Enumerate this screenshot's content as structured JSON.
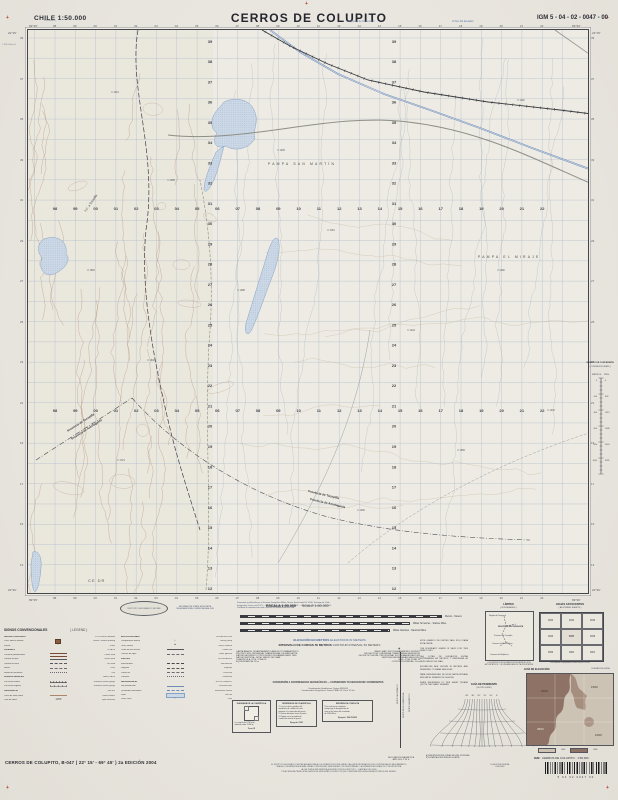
{
  "header": {
    "country_scale": "CHILE  1:50.000",
    "title": "CERROS DE COLUPITO",
    "sheet_code": "IGM 5 - 04 - 02 - 0047 - 00",
    "note_left": "Al Oeste de Greenwich",
    "note_right": "Al Sur del Ecuador"
  },
  "map": {
    "corner": {
      "tl_lon": "69°45'",
      "tr_lon": "69°30'",
      "tl_lat": "22°15'",
      "bl_lat": "22°30'",
      "ref_e": "398.000m E",
      "ref_n": "7.539.000m N"
    },
    "eastings": [
      "98",
      "99",
      "00",
      "01",
      "02",
      "03",
      "04",
      "05",
      "06",
      "07",
      "08",
      "09",
      "10",
      "11",
      "12",
      "13",
      "14",
      "15",
      "16",
      "17",
      "18",
      "19",
      "20",
      "21",
      "22"
    ],
    "northings": [
      "39",
      "38",
      "37",
      "36",
      "35",
      "34",
      "33",
      "32",
      "31",
      "30",
      "29",
      "28",
      "27",
      "26",
      "25",
      "24",
      "23",
      "22",
      "21",
      "20",
      "19",
      "18",
      "17",
      "16",
      "15",
      "14",
      "13",
      "12"
    ],
    "places": {
      "pampa1": "PAMPA SAN MARTÍN",
      "pampa2": "PAMPA EL MIRAJE",
      "prov_a": "Provincia de Tocopilla",
      "prov_b": "Provincia de Antofagasta",
      "rail_label": "F.C. a Tocopilla",
      "station": "CE DR"
    },
    "spots": [
      {
        "x": 84,
        "y": 62,
        "v": "1310"
      },
      {
        "x": 140,
        "y": 150,
        "v": "1485"
      },
      {
        "x": 60,
        "y": 240,
        "v": "1562"
      },
      {
        "x": 120,
        "y": 330,
        "v": "1640"
      },
      {
        "x": 90,
        "y": 430,
        "v": "1721"
      },
      {
        "x": 210,
        "y": 260,
        "v": "1288"
      },
      {
        "x": 300,
        "y": 200,
        "v": "1154"
      },
      {
        "x": 380,
        "y": 300,
        "v": "1243"
      },
      {
        "x": 470,
        "y": 240,
        "v": "1199"
      },
      {
        "x": 430,
        "y": 420,
        "v": "1356"
      },
      {
        "x": 520,
        "y": 380,
        "v": "1402"
      },
      {
        "x": 330,
        "y": 480,
        "v": "1450"
      },
      {
        "x": 250,
        "y": 120,
        "v": "1235"
      },
      {
        "x": 490,
        "y": 70,
        "v": "1120"
      }
    ]
  },
  "legend": {
    "title": "SIGNOS CONVENCIONALES",
    "title_en": "( LEGEND )",
    "col1": [
      {
        "h": "ÁREAS POBLADAS",
        "he": "POPULATED AREAS"
      },
      {
        "es": "Casa, edificio aislado",
        "en": "House, isolated building",
        "sym": "building"
      },
      {
        "es": "Ruinas",
        "en": "Ruins",
        "sym": "glyph",
        "g": "∷"
      },
      {
        "h": "CAMINOS",
        "he": "ROADS"
      },
      {
        "es": "Carretera pavimentada",
        "en": "Paved road",
        "sym": "road2"
      },
      {
        "es": "Camino de ripio",
        "en": "Gravel road",
        "sym": "road1"
      },
      {
        "es": "Camino de tierra",
        "en": "Dirt road",
        "sym": "roadd"
      },
      {
        "es": "Huella",
        "en": "Track",
        "sym": "dash"
      },
      {
        "es": "Senda de herradura",
        "en": "Trail",
        "sym": "dots"
      },
      {
        "h": "FERROCARRILES",
        "he": "RAILROADS"
      },
      {
        "es": "Vía férrea normal",
        "en": "Railroad, normal gauge",
        "sym": "rail"
      },
      {
        "es": "Vía férrea angosta",
        "en": "Railroad, narrow gauge",
        "sym": "rail2"
      },
      {
        "h": "OROGRAFÍA",
        "he": "RELIEF"
      },
      {
        "es": "Curva de nivel índice",
        "en": "Index contour",
        "sym": "contour"
      },
      {
        "es": "Cota de altura",
        "en": "Spot elevation",
        "sym": "glyph",
        "g": "·1250"
      }
    ],
    "col2": [
      {
        "h": "INSTALACIONES",
        "he": "INSTALLATIONS"
      },
      {
        "es": "Campamento minero",
        "en": "Mining camp",
        "sym": "glyph",
        "g": "▪"
      },
      {
        "es": "Torre, antena",
        "en": "Tower, antenna",
        "sym": "glyph",
        "g": "▲"
      },
      {
        "es": "Línea de alta tensión",
        "en": "Power line",
        "sym": "power"
      },
      {
        "es": "Cañería de agua",
        "en": "Water pipeline",
        "sym": "b3"
      },
      {
        "h": "LÍMITES",
        "he": "BOUNDARIES"
      },
      {
        "es": "Internacional",
        "en": "International",
        "sym": "b1"
      },
      {
        "es": "Regional",
        "en": "Regional",
        "sym": "b2"
      },
      {
        "es": "Provincial",
        "en": "Provincial",
        "sym": "b3"
      },
      {
        "es": "Comunal",
        "en": "Communal",
        "sym": "b4"
      },
      {
        "h": "HIDROGRAFÍA",
        "he": "HYDROGRAPHY"
      },
      {
        "es": "Río permanente",
        "en": "Perennial river",
        "sym": "river"
      },
      {
        "es": "Quebrada intermitente",
        "en": "Intermittent stream",
        "sym": "istream"
      },
      {
        "es": "Salar",
        "en": "Salt flat",
        "sym": "salar"
      },
      {
        "es": "Pozo, noria",
        "en": "Well",
        "sym": "glyph",
        "g": "○"
      }
    ]
  },
  "footer": {
    "logo_text": "INSTITUTO GEOGRÁFICO MILITAR",
    "pub_lines": [
      "Preparado y publicado por el Instituto Geográfico Militar, Nueva Santa Isabel N° 1640, Santiago de Chile.",
      "Fotografías aéreas año 1997 — Restitución fotogramétrica año 2000 — Comprobación terrestre año 2002.",
      "Prohibida la reproducción total o parcial sin autorización del IGM."
    ],
    "info_lines": [
      "INFORMACIÓN SOBRE ESTA CARTA",
      "SE AGRADECERÁ COMUNICARLA AL IGM"
    ],
    "escala": "ESCALA 1:50.000",
    "escala_en": "SCALE 1:50.000",
    "bar_labels": [
      "Metros · Meters",
      "Millas Terrestres · Statute Miles",
      "Millas Náuticas · Nautical Miles"
    ],
    "elev": "ELEVACIÓN EN METROS",
    "elev_en": "ELEVATIONS IN METERS",
    "interval": "INTERVALO DE CURVAS 50 METROS",
    "interval_en": "CONTOUR INTERVAL 50 METERS",
    "datum_es": [
      "CARTA BÁSICA: LEVANTAMIENTO AEROFOTOGRAMÉTRICO",
      "PROYECCIÓN: UNIVERSAL TRANSVERSAL DE MERCATOR",
      "DATUM GEODÉSICO: PROVISORIO SUDAMERICANO 1956",
      "DATUM VERTICAL: NIVEL MEDIO DEL MAR",
      "CUADRÍCULA: UTM, ZONA 19",
      "EQUIDISTANCIA: 50 m"
    ],
    "datum_en": [
      "BASIC MAP: PHOTOGRAMMETRIC SURVEY",
      "PROJECTION: UNIVERSAL TRANSVERSE MERCATOR",
      "GEODETIC DATUM: PROVISIONAL SOUTH AMERICAN 1956",
      "VERTICAL DATUM: MEAN SEA LEVEL",
      "GRID: UTM, ZONE 19",
      "CONTOUR INTERVAL: 50 m"
    ],
    "conv_title": "CONVERSIÓN A COORDENADAS GEOGRÁFICAS — CONVERSION TO GEOGRAPHIC COORDINATES",
    "conv_lines": [
      "Coordenadas Geodésicas: Datum WGS-84",
      "Coordenadas Geográficas: Datum PSAD-56, Zona 19 Sur"
    ],
    "box1": {
      "title": "DIAGRAMA DE LA CUADRÍCULA",
      "lines": [
        "La cuadrícula UTM está",
        "indicada cada 1.000 m"
      ],
      "example": "Zona 19"
    },
    "box2": {
      "title": "REFERENCIA DE CUADRÍCULA",
      "lines": [
        "1. Lea las cifras grandes del",
        "meridiano de cuadrícula más",
        "próximo a la izquierda del punto.",
        "2. Estime décimos hacia el punto.",
        "3. Repita con el paralelo de",
        "cuadrícula inferior al punto."
      ],
      "example": "Ejemplo: 0536"
    },
    "box3": {
      "title": "REFERENCIA COMPLETA",
      "lines": [
        "Para referencia completa",
        "anteponga la designación de",
        "zona y las letras del cuadrado",
        "de 100.000 m."
      ],
      "example": "Ejemplo: 19K 053653"
    },
    "magnetic": {
      "n1": "NORTE GEOGRÁFICO",
      "n2": "NORTE DE LA CUADRÍCULA",
      "n3": "NORTE MAGNÉTICO",
      "note": [
        "DECLINACIÓN MAGNÉTICA",
        "AÑO 2004: 2°30' E"
      ]
    },
    "notes_col": [
      "ESTE GRÁFICO DE LÍMITES VALE SÓLO PARA ESTA CARTA.",
      "THE BOUNDARY GRAPH IS VALID FOR THIS SHEET ONLY.",
      "LAS COTAS DE ELEVACIÓN ESTÁN EXPRESADAS EN METROS Y REFERIDAS AL NIVEL MEDIO DEL MAR.",
      "ELEVATIONS ARE SHOWN IN METERS AND REFERRED TO MEAN SEA LEVEL.",
      "PARA REFERENCIAS DE ESTA CARTA SÍRVASE INDICAR EL NÚMERO DE LA HOJA.",
      "WHEN REFERRING TO THIS SHEET PLEASE QUOTE THE SHEET NUMBER."
    ],
    "limites": {
      "title": "LÍMITES",
      "title_en": "( BOUNDARIES )",
      "labels": [
        "Región de Tarapacá",
        "REGIÓN DE ANTOFAGASTA",
        "Provincia de Tocopilla",
        "Comuna de María Elena",
        "Comuna de Mejillones"
      ],
      "note": "LOS LÍMITES QUE FIGURAN EN ESTA CARTA NO SON AUTORITATIVOS — BOUNDARIES ARE NOT AUTHORITATIVE"
    },
    "adjoining": {
      "title": "HOJAS ADYACENTES",
      "title_en": "( ADJOINING SHEETS )",
      "cells": [
        "0033",
        "0034",
        "0035",
        "0046",
        "0047",
        "0048",
        "0059",
        "0060",
        "0061"
      ],
      "note": "Los números corresponden a cartas escala 1:50.000"
    },
    "slope": {
      "title": "GUÍA DE PENDIENTE",
      "title_en": "( SLOPE GUIDE )",
      "top_labels": [
        "45°",
        "30°",
        "20°",
        "15°",
        "10°",
        "5°"
      ],
      "foot": [
        "A) PENDIENTE ENTRE CURVAS DE NIVEL SUCESIVAS",
        "B) DISTANCIA HORIZONTAL EN LA CARTA"
      ]
    },
    "elevguide": {
      "title": "GUÍA DE ELEVACIÓN",
      "title_en": "ELEVATION GUIDE",
      "labels": [
        "2000",
        "1500",
        "1000",
        "2500"
      ],
      "legend": [
        "1040",
        "3065"
      ]
    },
    "conversion": {
      "title": "GRÁFICO DE CONVERSIÓN",
      "subtitle": "( CONVERSION GRAPH )",
      "left": "METROS",
      "right": "PIES",
      "m": [
        "0",
        "200",
        "400",
        "600",
        "800",
        "1000"
      ],
      "p": [
        "0",
        "656",
        "1312",
        "1968",
        "2624",
        "3281"
      ]
    },
    "bottom": {
      "title_line": "CERROS DE COLUPITO, B-047 ( 22° 15' - 69° 45' ) 2a EDICIÓN 2004",
      "center_lines": [
        "EL INSTITUTO GEOGRÁFICO MILITAR AGRADECERÁ A LOS USUARIOS DE ESTA CARTA CUALQUIER INFORMACIÓN QUE CONTRIBUYA A SU MEJORAMIENTO,",
        "SEA EN LO REFERENTE A NUEVAS OBRAS CONSTRUIDAS, VÍAS NUEVAS O NO REGISTRADAS, O A NOMBRES GEOGRÁFICOS Y SU ESCRITURA,",
        "LA QUE PUEDE SER REMITIDA A LA DIRECCIÓN DEL INSTITUTO — SANTIAGO DE CHILE.",
        "TODA PERSONA TIENE LA OBLIGACIÓN DE DENUNCIAR LOS DELITOS QUE COMPROMETEN LA SEGURIDAD EXTERIOR DEL ESTADO."
      ],
      "small_block": [
        "2a EDICIÓN DIGITAL",
        "IGM 2004"
      ],
      "igm_bold": "IGM",
      "igm_rest": " · CERROS DE COLUPITO · 1:50.000",
      "barcode_digits": "5  04  02  0047  00"
    }
  },
  "colors": {
    "accent_blue": "#6d8db8",
    "contour_brown": "#a9856a",
    "salar_fill": "#ccd8e6",
    "rail_dark": "#3b3c42",
    "paper": "#e8e5de"
  }
}
